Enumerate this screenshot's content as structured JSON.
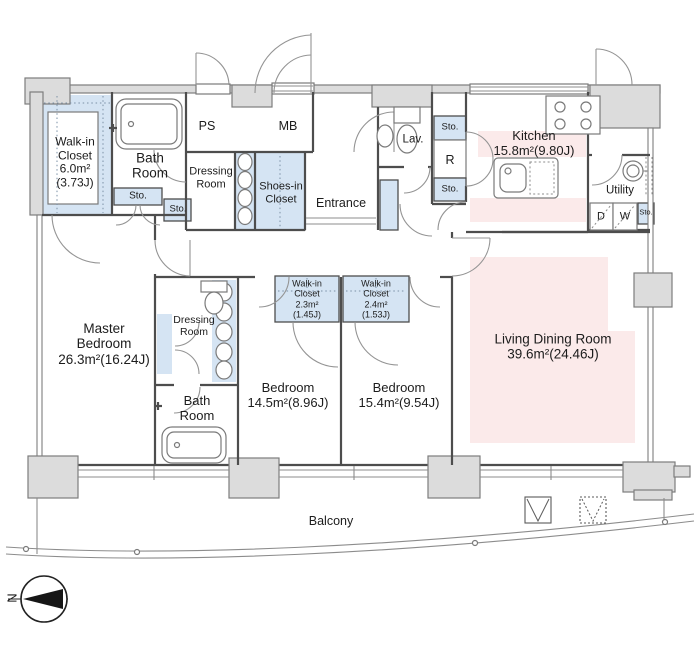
{
  "rooms": {
    "walk_in_closet_main": "Walk-in\nCloset\n6.0m²\n(3.73J)",
    "bath_room_main": "Bath\nRoom",
    "ps": "PS",
    "mb": "MB",
    "dressing_room_entry": "Dressing\nRoom",
    "shoes_in_closet": "Shoes-in\nCloset",
    "entrance": "Entrance",
    "lavatory": "Lav.",
    "refrigerator": "R",
    "kitchen": "Kitchen\n15.8m²(9.80J)",
    "utility": "Utility",
    "dryer": "D",
    "washer": "W",
    "master_bedroom": "Master\nBedroom\n26.3m²(16.24J)",
    "dressing_room_master": "Dressing\nRoom",
    "bath_room_master": "Bath\nRoom",
    "walk_in_closet_bedroom1": "Walk-in\nCloset\n2.3m²\n(1.45J)",
    "walk_in_closet_bedroom2": "Walk-in\nCloset\n2.4m²\n(1.53J)",
    "bedroom1": "Bedroom\n14.5m²(8.96J)",
    "bedroom2": "Bedroom\n15.4m²(9.54J)",
    "living_dining_room": "Living Dining Room\n39.6m²(24.46J)",
    "balcony": "Balcony"
  },
  "labels": {
    "storage": "Sto.",
    "north": "N"
  },
  "colors": {
    "wall_fill": "#dcdcdc",
    "wall_outline": "#7d7d7d",
    "partition": "#4d4d4d",
    "closet_blue": "#d5e4f3",
    "highlight_pink": "#fbeaea",
    "ink": "#1c1c1c"
  }
}
